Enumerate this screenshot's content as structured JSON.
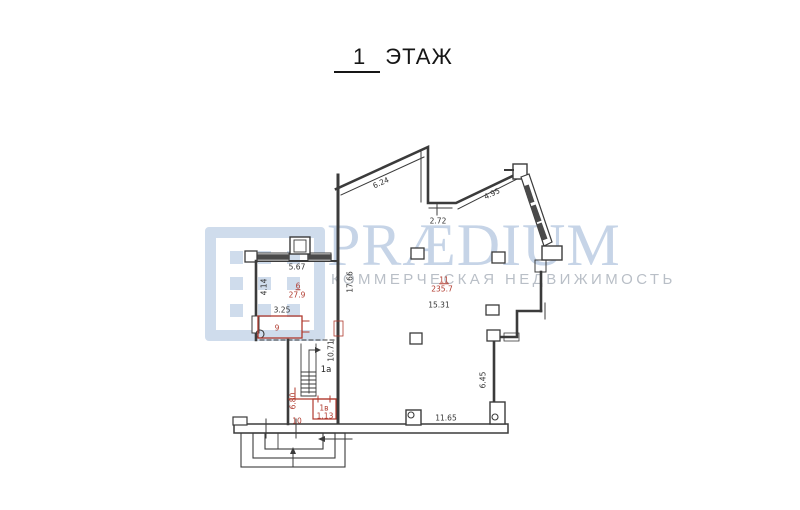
{
  "title": {
    "number": "1",
    "word": "ЭТАЖ"
  },
  "watermark": {
    "brand": "PRÆDIUM",
    "tagline": "КОММЕРЧЕСКАЯ НЕДВИЖИМОСТЬ",
    "brand_color": "#c6d4e7",
    "tagline_color": "#b9bfc7",
    "logo_color": "#cfdcec"
  },
  "plan": {
    "line_color": "#3b3b3b",
    "annotation_color": "#b03a2e",
    "labels": [
      {
        "text": "6.24",
        "x": 381,
        "y": 183,
        "rot": -24,
        "kind": "dim"
      },
      {
        "text": "2.72",
        "x": 438,
        "y": 221,
        "rot": 0,
        "kind": "dim"
      },
      {
        "text": "4.95",
        "x": 492,
        "y": 194,
        "rot": -26,
        "kind": "dim"
      },
      {
        "text": "5.67",
        "x": 297,
        "y": 267,
        "rot": 0,
        "kind": "dim"
      },
      {
        "text": "4.14",
        "x": 264,
        "y": 287,
        "rot": -90,
        "kind": "dim"
      },
      {
        "text": "17.66",
        "x": 350,
        "y": 282,
        "rot": -90,
        "kind": "dim"
      },
      {
        "text": "3.25",
        "x": 282,
        "y": 310,
        "rot": 0,
        "kind": "dim"
      },
      {
        "text": "15.31",
        "x": 439,
        "y": 305,
        "rot": 0,
        "kind": "dim"
      },
      {
        "text": "10.71",
        "x": 331,
        "y": 351,
        "rot": -90,
        "kind": "dim"
      },
      {
        "text": "6.45",
        "x": 483,
        "y": 380,
        "rot": -90,
        "kind": "dim"
      },
      {
        "text": "11.65",
        "x": 446,
        "y": 418,
        "rot": 0,
        "kind": "dim"
      },
      {
        "text": "6",
        "x": 298,
        "y": 286,
        "rot": 0,
        "kind": "red-u"
      },
      {
        "text": "27.9",
        "x": 297,
        "y": 295,
        "rot": 0,
        "kind": "red"
      },
      {
        "text": "9",
        "x": 277,
        "y": 328,
        "rot": 0,
        "kind": "red"
      },
      {
        "text": "11",
        "x": 444,
        "y": 280,
        "rot": 0,
        "kind": "red-u"
      },
      {
        "text": "235.7",
        "x": 442,
        "y": 289,
        "rot": 0,
        "kind": "red"
      },
      {
        "text": "1a",
        "x": 326,
        "y": 370,
        "rot": 0,
        "kind": "room"
      },
      {
        "text": "6.80",
        "x": 293,
        "y": 401,
        "rot": -90,
        "kind": "red"
      },
      {
        "text": "10",
        "x": 297,
        "y": 421,
        "rot": 0,
        "kind": "red"
      },
      {
        "text": "1в",
        "x": 324,
        "y": 408,
        "rot": 0,
        "kind": "red"
      },
      {
        "text": "1.13",
        "x": 325,
        "y": 416,
        "rot": 0,
        "kind": "red"
      }
    ]
  }
}
